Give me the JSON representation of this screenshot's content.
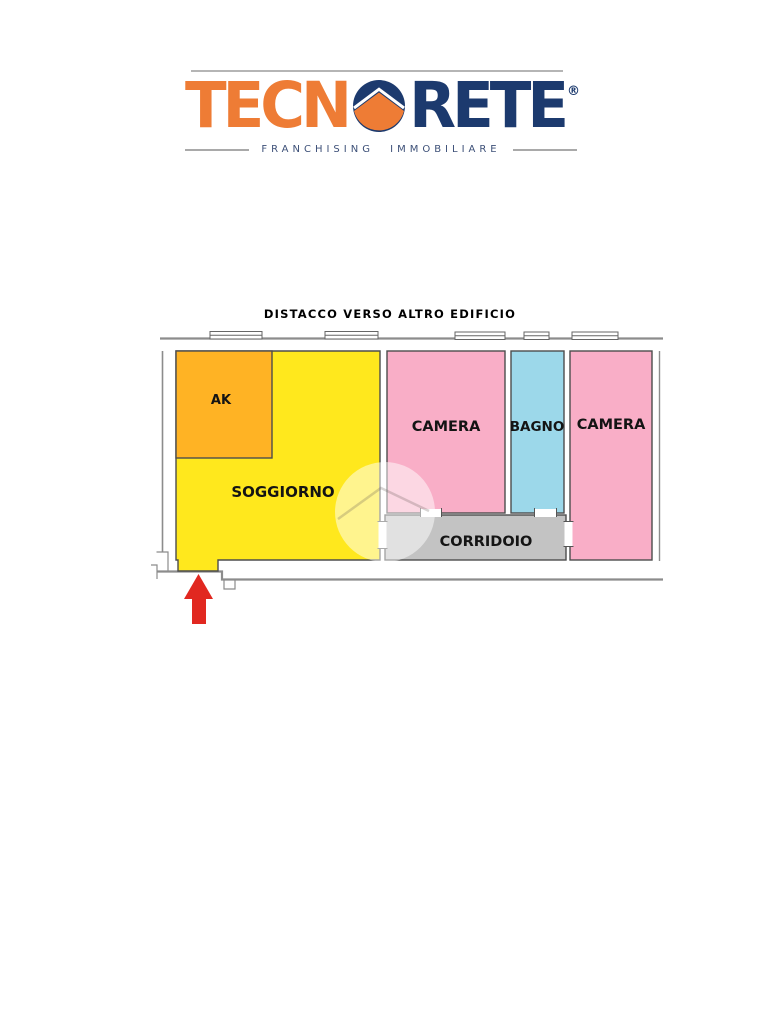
{
  "logo": {
    "part1": "TECN",
    "part2": "RETE",
    "registered": "®",
    "tagline": "FRANCHISING IMMOBILIARE",
    "orange": "#ee7c35",
    "navy": "#1c3a6e"
  },
  "plan": {
    "title": "DISTACCO VERSO ALTRO EDIFICIO",
    "rooms": [
      {
        "name": "AK",
        "color": "#ffb324"
      },
      {
        "name": "SOGGIORNO",
        "color": "#ffe81d"
      },
      {
        "name": "CAMERA",
        "color": "#f9aec7"
      },
      {
        "name": "BAGNO",
        "color": "#9cd8ea"
      },
      {
        "name": "CAMERA",
        "color": "#f9aec7"
      },
      {
        "name": "CORRIDOIO",
        "color": "#c3c3c3"
      }
    ],
    "entrance_arrow_color": "#e12820",
    "wall_color": "#8c8c8c"
  }
}
